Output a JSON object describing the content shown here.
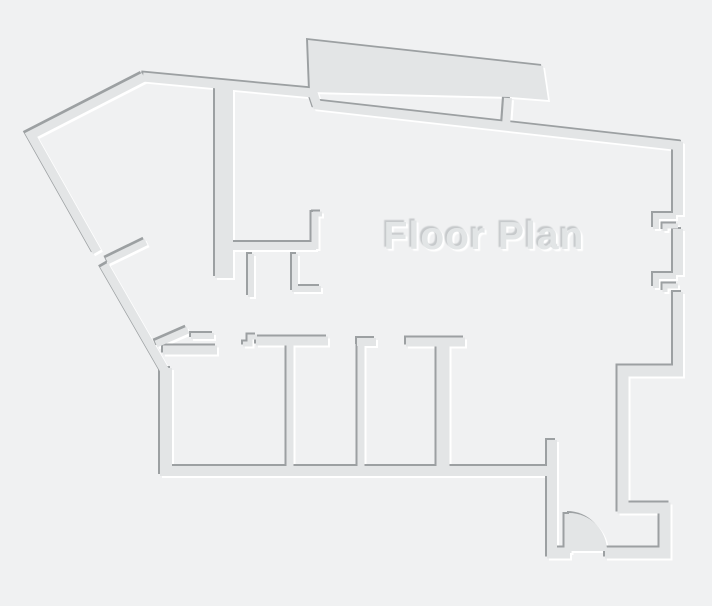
{
  "title": "Floor Plan",
  "canvas": {
    "width": 712,
    "height": 606
  },
  "colors": {
    "background": "#f0f1f2",
    "wall": "#e3e5e6",
    "wall_shadow": "#9ca0a2",
    "highlight": "#ffffff",
    "title_fill": "#e2e5e6",
    "title_shadow": "#c6c9cb"
  },
  "title_pos": {
    "x": 484,
    "y": 249
  },
  "floorplan": {
    "walls": [
      {
        "name": "terrace-slab",
        "fill": true,
        "d": "M308,40 L543,66 L548,100 L510,97 L310,92 Z"
      },
      {
        "name": "door-swing-arc",
        "fill": true,
        "d": "M569,513 A38,38 0 0 1 607,551 L569,551 Z"
      },
      {
        "name": "outer-wall-top-left-diagonals",
        "d": "M144,77 L31,135 L97,252",
        "w": 9
      },
      {
        "name": "outer-wall-lower-diagonal",
        "d": "M104,265 L165,371",
        "w": 9
      },
      {
        "name": "outer-wall-top",
        "d": "M143,77 L313,93 L317,105 L682,146",
        "w": 9
      },
      {
        "name": "terrace-side-wall",
        "d": "M508,98 L506,126",
        "w": 8
      },
      {
        "name": "right-wall-upper",
        "d": "M678,142 L678,215",
        "w": 10
      },
      {
        "name": "right-wall-middle",
        "d": "M678,229 L678,275",
        "w": 10
      },
      {
        "name": "right-wall-lower",
        "d": "M678,292 L678,372",
        "w": 10
      },
      {
        "name": "window-jamb-1-bar",
        "d": "M655,216 L676,216",
        "w": 6
      },
      {
        "name": "window-jamb-1-lip",
        "d": "M656,213 L656,229",
        "w": 6
      },
      {
        "name": "window-jamb-1-step",
        "d": "M665,231 L665,226 L678,226",
        "w": 5
      },
      {
        "name": "window-jamb-2-bar",
        "d": "M655,276 L676,276",
        "w": 6
      },
      {
        "name": "window-jamb-2-lip",
        "d": "M656,273 L656,288",
        "w": 6
      },
      {
        "name": "window-jamb-2-step",
        "d": "M665,292 L665,286 L678,286",
        "w": 5
      },
      {
        "name": "bottom-right-step-wall",
        "d": "M683,371 L623,371 L623,508 L665,508 L665,553 L605,553",
        "w": 11
      },
      {
        "name": "building-bottom-stub",
        "d": "M547,553 L570,553",
        "w": 11
      },
      {
        "name": "door-leaf",
        "d": "M568,514 L568,553",
        "w": 7
      },
      {
        "name": "corridor-east-wall",
        "d": "M552,440 L552,558",
        "w": 10
      },
      {
        "name": "rooms-bottom-wall",
        "d": "M160,471 L553,471",
        "w": 10
      },
      {
        "name": "left-wall",
        "d": "M166,368 L166,472",
        "w": 12
      },
      {
        "name": "entry-spur-wall",
        "d": "M107,261 L146,242",
        "w": 7
      },
      {
        "name": "interior-thick-wall",
        "d": "M224,87 L224,278",
        "w": 18
      },
      {
        "name": "small-room-south-wall",
        "d": "M233,246 L316,246",
        "w": 8
      },
      {
        "name": "small-room-east-wall",
        "d": "M315,249 L315,212",
        "w": 7
      },
      {
        "name": "small-room-east-lip",
        "d": "M313,214 L322,214",
        "w": 5
      },
      {
        "name": "closet-stub-a",
        "d": "M251,254 L251,297",
        "w": 6
      },
      {
        "name": "closet-stub-b",
        "d": "M295,254 L295,289 L321,289",
        "w": 6
      },
      {
        "name": "entry-diagonal-stub",
        "d": "M156,344 L188,330",
        "w": 7
      },
      {
        "name": "entry-horizontal-stub",
        "d": "M191,336 L214,336",
        "w": 6
      },
      {
        "name": "room1-top-wall",
        "d": "M163,350 L217,350",
        "w": 9
      },
      {
        "name": "corridor-step-piece",
        "d": "M243,344 L250,344 L250,337 L257,337",
        "w": 5
      },
      {
        "name": "corridor-south-wall",
        "d": "M256,341 L328,341",
        "w": 9
      },
      {
        "name": "room-divider-1",
        "d": "M290,345 L290,467",
        "w": 7
      },
      {
        "name": "room-divider-2-stub",
        "d": "M357,342 L376,342",
        "w": 8
      },
      {
        "name": "room-divider-2",
        "d": "M361,343 L361,467",
        "w": 7
      },
      {
        "name": "room3-top-wall",
        "d": "M406,342 L465,342",
        "w": 9
      },
      {
        "name": "room-divider-3",
        "d": "M443,346 L443,467",
        "w": 13
      }
    ]
  }
}
